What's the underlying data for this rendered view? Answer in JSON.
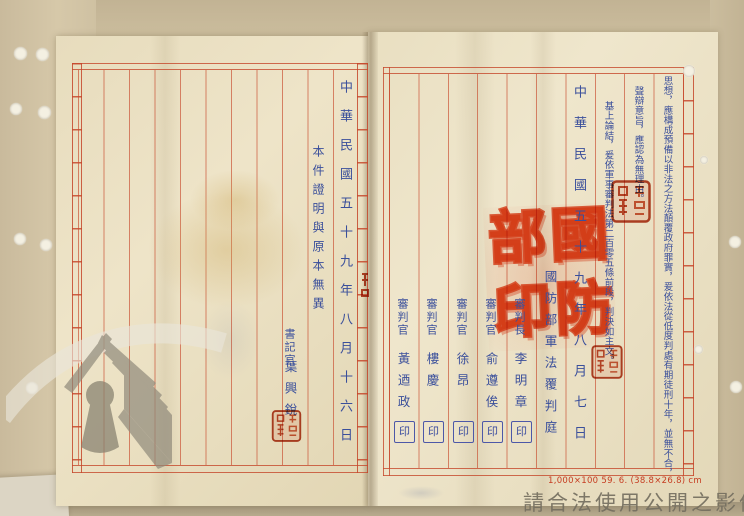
{
  "document": {
    "left_page": {
      "certification": "本件證明與原本無異",
      "clerk_title": "書記官",
      "clerk_name": "葉興銳",
      "date": "中華民國五十九年八月十六日"
    },
    "right_page": {
      "reason_line_1": "思想，應構成預備以非法之方法顛覆政府罪實，爰依法從低度判處有期徒刑十年，並無不合，",
      "reason_line_2": "聲辯意旨，應認為無理由。",
      "reason_line_3": "基上論結，爰依軍事審判法第二百零五條前段，判決如主文。",
      "date": "中華民國五十九年八月七日",
      "court": "國防部軍法覆判庭",
      "judges": [
        {
          "title": "審判長",
          "name": "李明章"
        },
        {
          "title": "審判官",
          "name": "俞遵俟"
        },
        {
          "title": "審判官",
          "name": "徐昂"
        },
        {
          "title": "審判官",
          "name": "樓慶"
        },
        {
          "title": "審判官",
          "name": "黃迺政"
        }
      ],
      "seal_mark": "印",
      "print_note": "1,000×100 59. 6. (38.8×26.8) cm"
    }
  },
  "seals": {
    "large": {
      "chars": [
        "國",
        "防",
        "部",
        "印"
      ]
    }
  },
  "watermark": {
    "usage_text": "請合法使用公開之影像"
  },
  "colors": {
    "paper": "#ece2c6",
    "rule_red": "#c64c2e",
    "ink_blue": "#3a4f9b",
    "seal_red": "#e33b12",
    "watermark_gray": "#756f60"
  }
}
